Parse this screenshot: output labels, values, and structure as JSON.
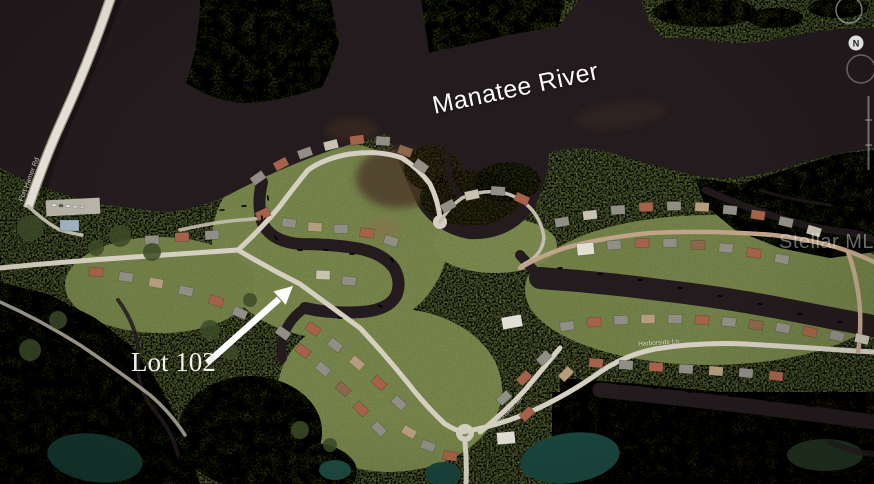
{
  "annotations": {
    "river_label": "Manatee River",
    "lot_label": "Lot 102",
    "watermark": "Stellar MLS",
    "compass_north": "N",
    "road_labels": [
      {
        "text": "Fort Hamer Rd"
      },
      {
        "text": "Portside Ter"
      },
      {
        "text": "Harborside Ln"
      }
    ]
  },
  "colors": {
    "river_water": "#231b1e",
    "base_land": "#6d7b47",
    "marsh": "#49502e",
    "road": "#d5cfc1",
    "pond_teal": "#1a463d",
    "roof_terracotta": "#a5614a",
    "label_text": "#fdfdfd",
    "watermark_text": "rgba(255,255,255,0.40)"
  }
}
